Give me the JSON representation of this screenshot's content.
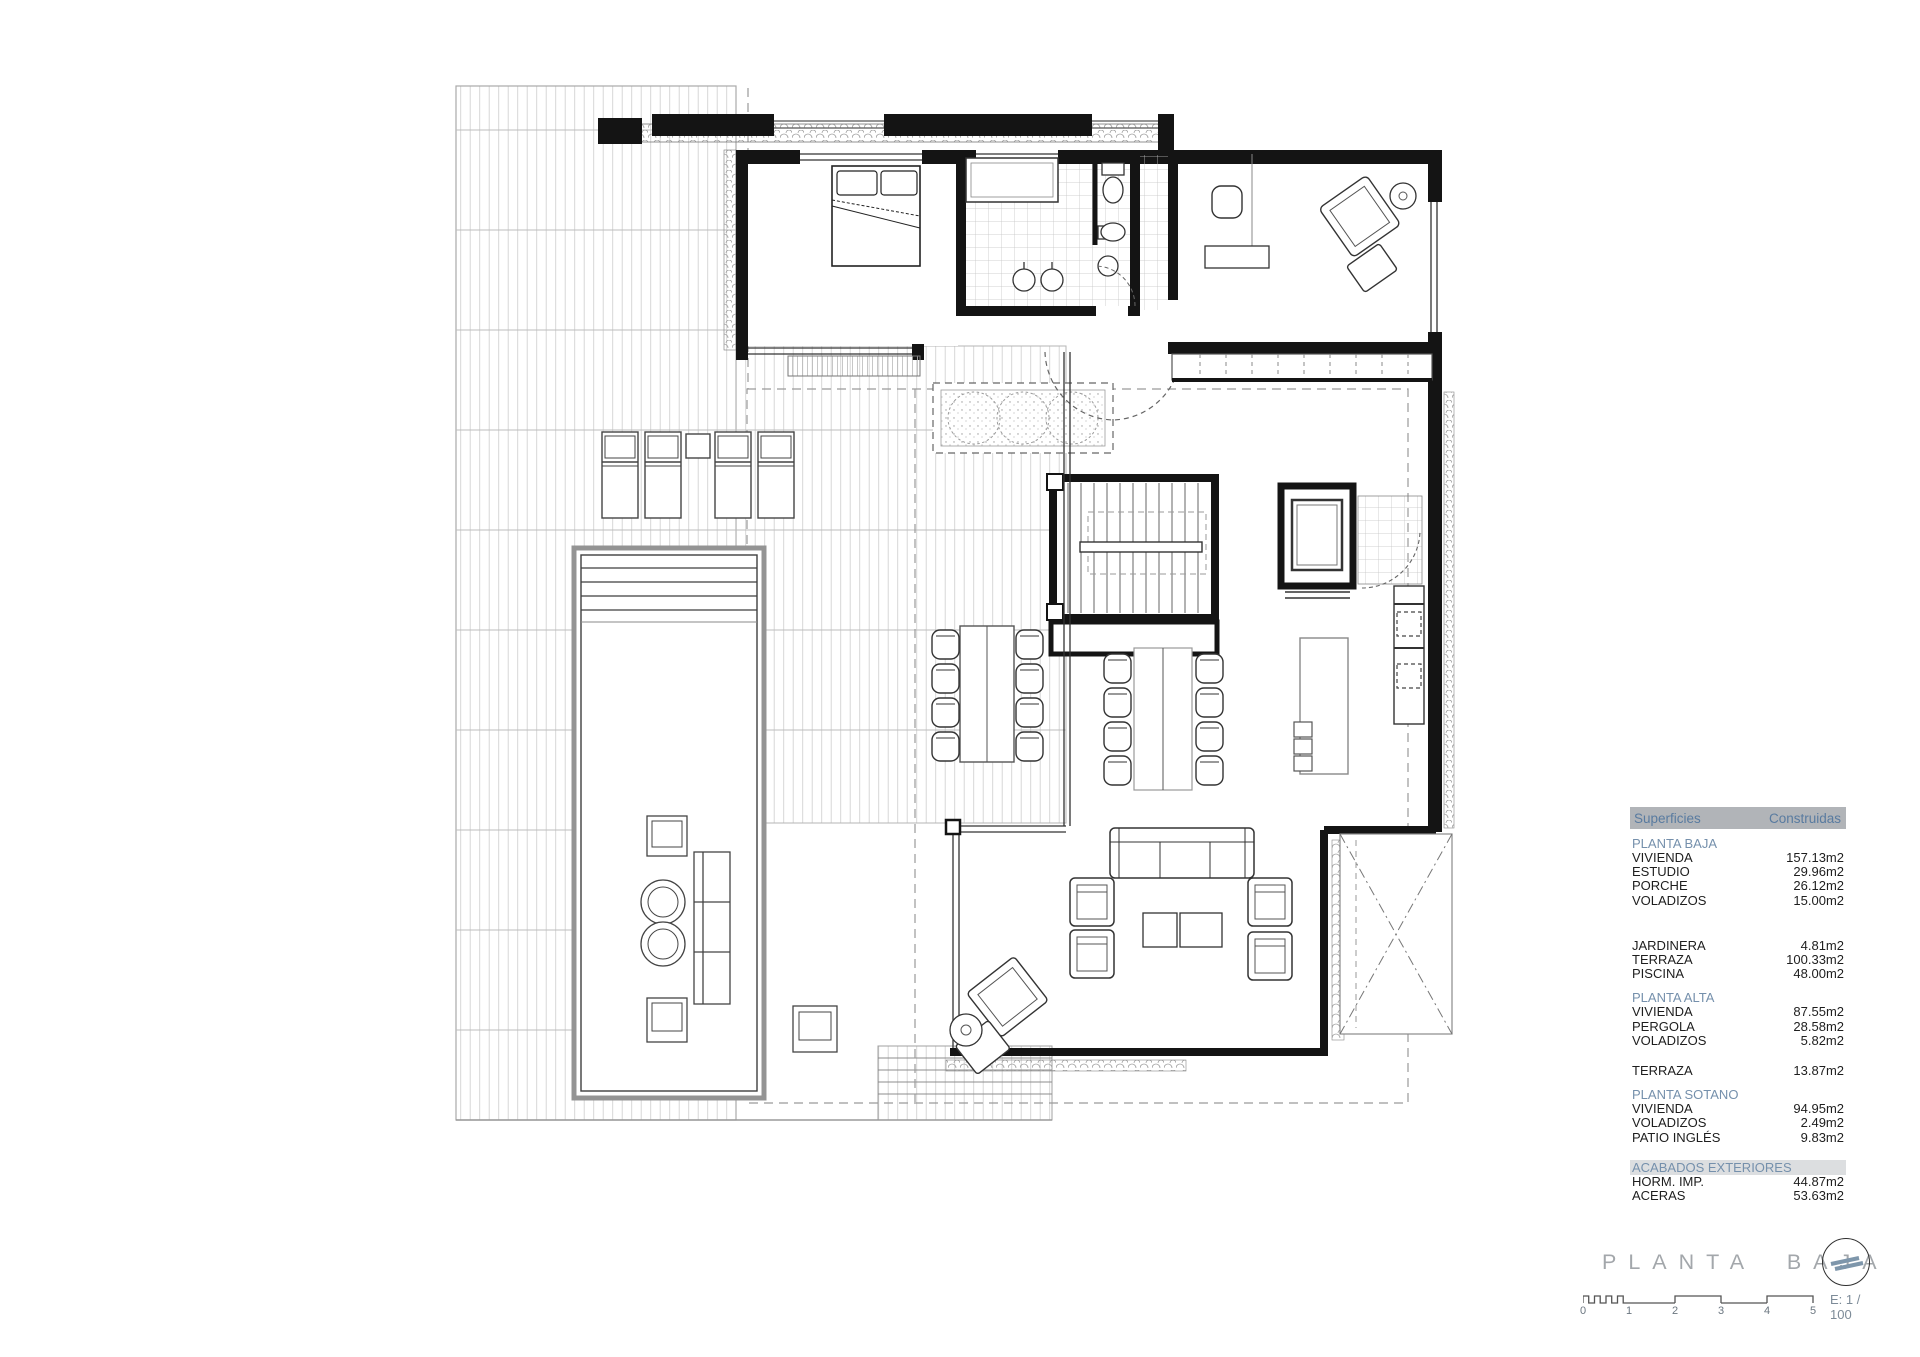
{
  "title_block": {
    "title": "PLANTA BAJA",
    "compass_icon": "north-arrow-icon",
    "accent_color": "#7e96ab",
    "title_color": "#a3a7ab"
  },
  "surfaces_table": {
    "header": {
      "col1": "Superficies",
      "col2": "Construidas"
    },
    "header_bg": "#b1b4b8",
    "header_text_color": "#597ba0",
    "section_text_color": "#7590ac",
    "sections": [
      {
        "header": "PLANTA BAJA",
        "items": [
          {
            "label": "VIVIENDA",
            "value": "157.13m2"
          },
          {
            "label": "ESTUDIO",
            "value": "29.96m2"
          },
          {
            "label": "PORCHE",
            "value": "26.12m2"
          },
          {
            "label": "VOLADIZOS",
            "value": "15.00m2"
          }
        ]
      },
      {
        "header": "",
        "items": [
          {
            "label": "JARDINERA",
            "value": "4.81m2"
          },
          {
            "label": "TERRAZA",
            "value": "100.33m2"
          },
          {
            "label": "PISCINA",
            "value": "48.00m2"
          }
        ]
      },
      {
        "header": "PLANTA ALTA",
        "items": [
          {
            "label": "VIVIENDA",
            "value": "87.55m2"
          },
          {
            "label": "PERGOLA",
            "value": "28.58m2"
          },
          {
            "label": "VOLADIZOS",
            "value": "5.82m2"
          }
        ]
      },
      {
        "header": "",
        "items": [
          {
            "label": "TERRAZA",
            "value": "13.87m2"
          }
        ]
      },
      {
        "header": "PLANTA SOTANO",
        "items": [
          {
            "label": "VIVIENDA",
            "value": "94.95m2"
          },
          {
            "label": "VOLADIZOS",
            "value": "2.49m2"
          },
          {
            "label": "PATIO INGLÉS",
            "value": "9.83m2"
          }
        ]
      },
      {
        "header": "ACABADOS EXTERIORES",
        "items": [
          {
            "label": "HORM. IMP.",
            "value": "44.87m2"
          },
          {
            "label": "ACERAS",
            "value": "53.63m2"
          }
        ]
      }
    ]
  },
  "scale_bar": {
    "ticks": [
      "0",
      "1",
      "2",
      "3",
      "4",
      "5"
    ],
    "label": "E: 1 / 100"
  }
}
